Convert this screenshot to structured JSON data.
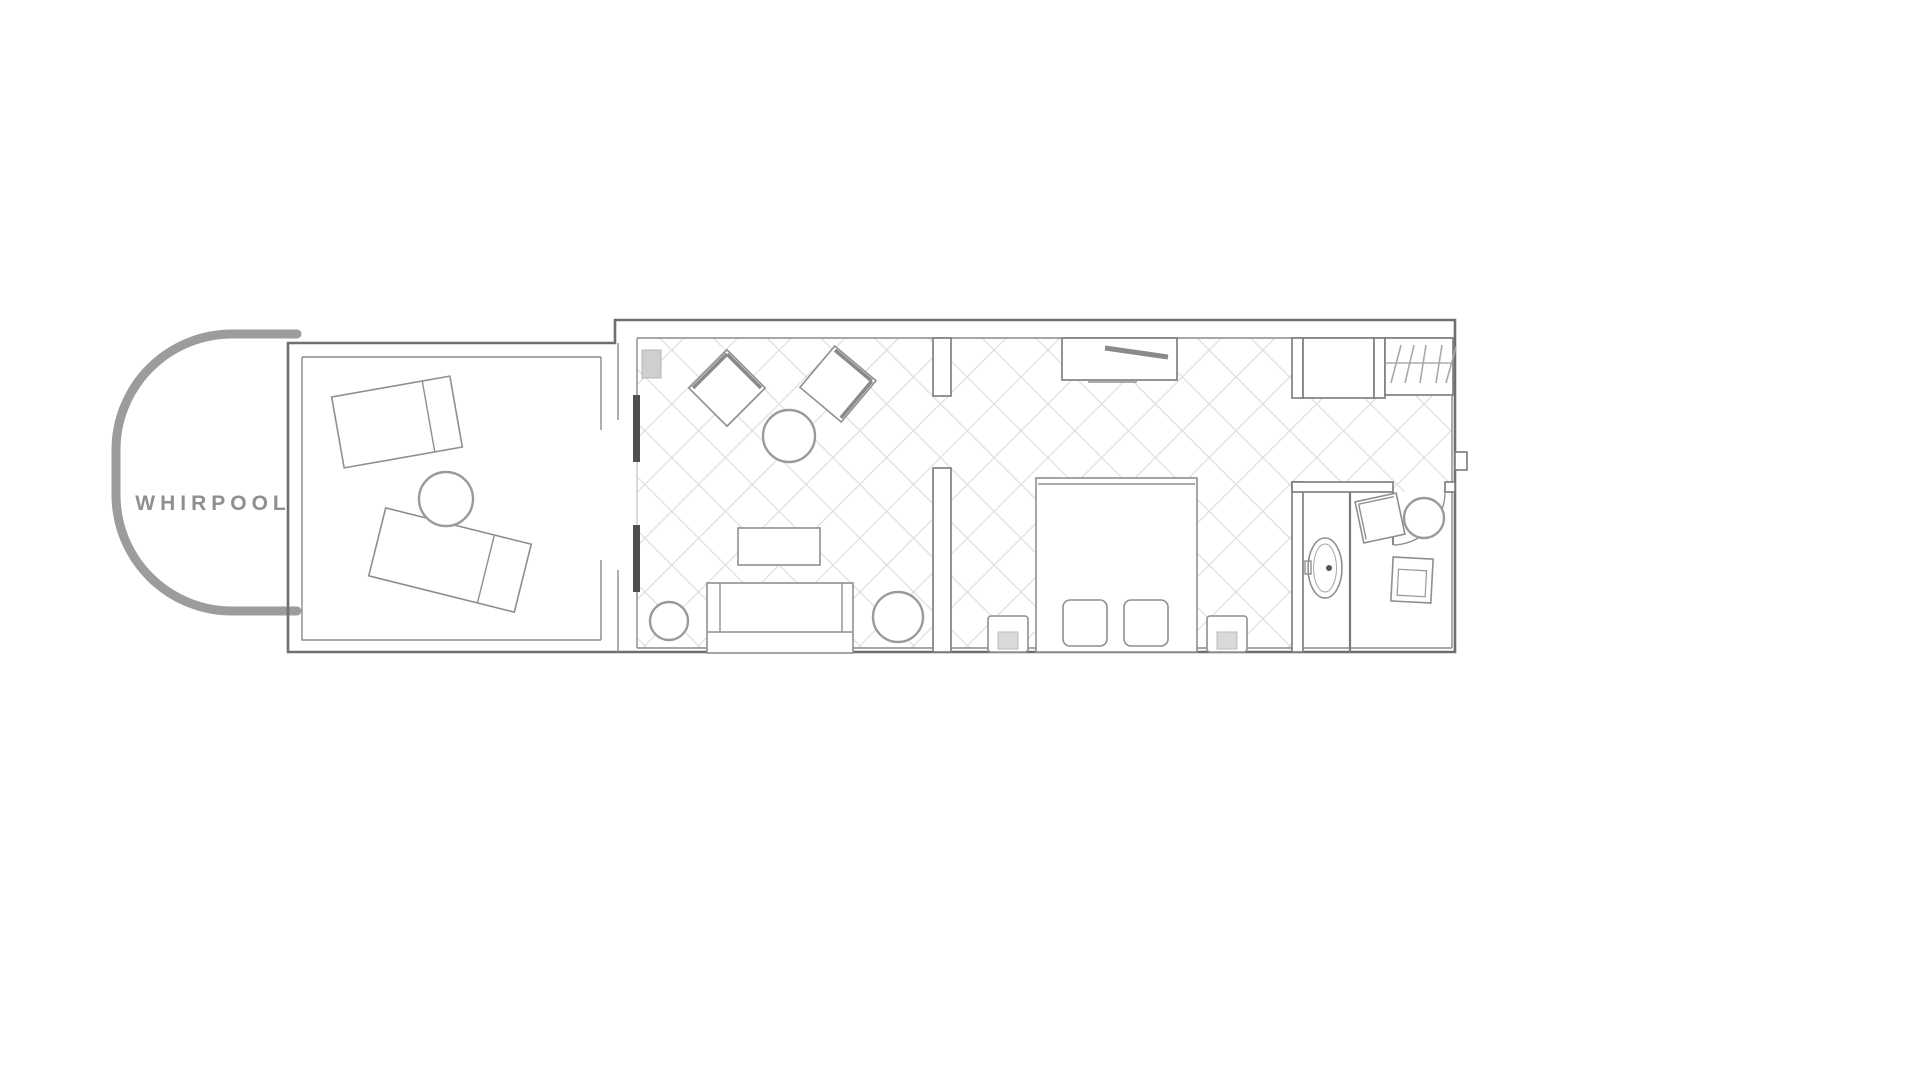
{
  "whirlpool": {
    "label": "WHIRPOOL",
    "label_color": "#8f8f8f",
    "outline_color": "#9c9c9c"
  },
  "palette": {
    "background": "#ffffff",
    "outer_wall": "#6f6f6f",
    "inner_wall": "#8a8a8a",
    "furniture_stroke": "#8f8f8f",
    "tile_line": "#dcdcdc",
    "door_panel": "#4f4f4f",
    "tv_fill": "#cfcfcf",
    "nightstand_inset": "#d9d9d9"
  },
  "rooms": [
    {
      "id": "whirlpool",
      "name": "whirlpool"
    },
    {
      "id": "terrace",
      "name": "terrace"
    },
    {
      "id": "living-area",
      "name": "living area"
    },
    {
      "id": "sleeping-area",
      "name": "sleeping area"
    },
    {
      "id": "bathroom",
      "name": "bathroom"
    },
    {
      "id": "sitting-corner",
      "name": "sitting corner"
    },
    {
      "id": "wardrobe-niche",
      "name": "wardrobe niche"
    }
  ],
  "items": [
    "sun-lounger",
    "sun-lounger",
    "terrace-round-table",
    "sliding-door-panels",
    "wall-tv",
    "armchair",
    "armchair",
    "round-coffee-table",
    "rectangular-coffee-table",
    "sofa",
    "round-pouf",
    "round-pouf",
    "desk-shelf-niche",
    "double-bed",
    "pillow",
    "pillow",
    "nightstand",
    "nightstand",
    "closet",
    "wardrobe-with-hangers",
    "washbasin",
    "door-swing",
    "side-chair",
    "round-side-table",
    "side-chair"
  ]
}
